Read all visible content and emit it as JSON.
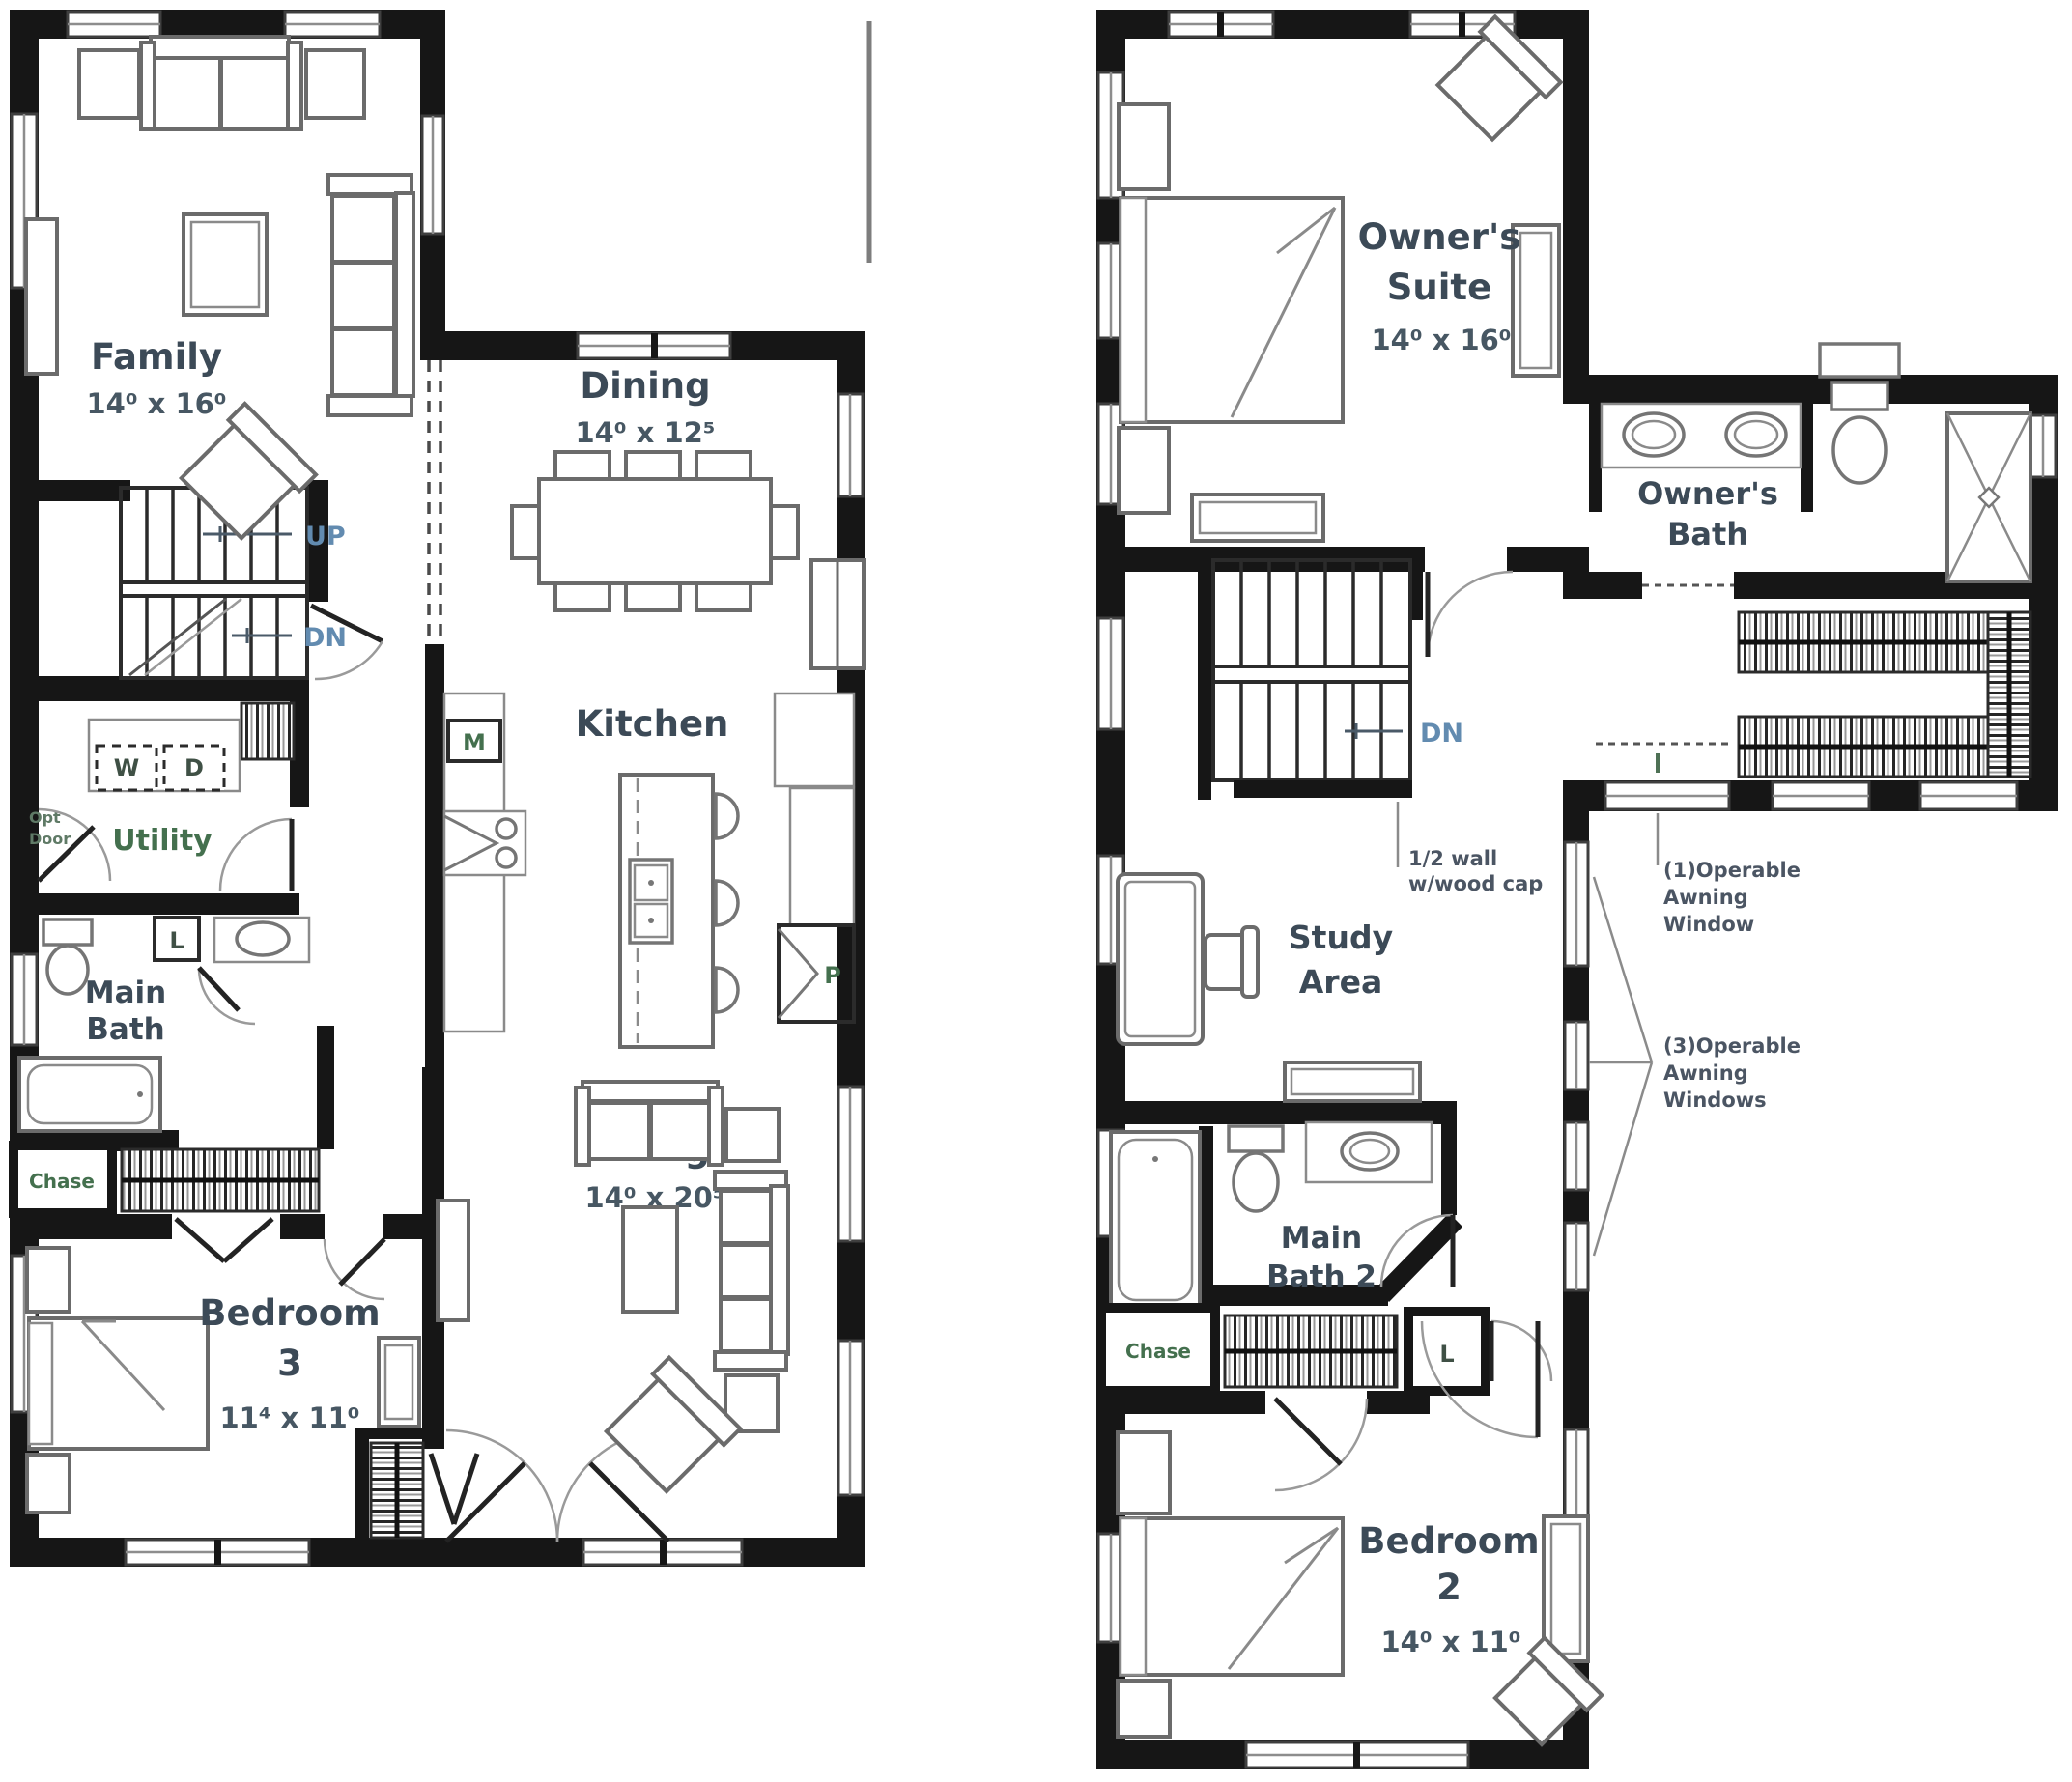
{
  "floor1": {
    "family": {
      "name": "Family",
      "dims": "14⁰ x 16⁰"
    },
    "dining": {
      "name": "Dining",
      "dims": "14⁰ x 12⁵"
    },
    "kitchen": {
      "name": "Kitchen"
    },
    "living": {
      "name": "Living",
      "dims": "14⁰ x 20⁵"
    },
    "utility": {
      "name": "Utility"
    },
    "main_bath": {
      "line1": "Main",
      "line2": "Bath"
    },
    "bedroom3": {
      "line1": "Bedroom",
      "line2": "3",
      "dims": "11⁴ x 11⁰"
    },
    "stair_up": "UP",
    "stair_dn": "DN",
    "washer": "W",
    "dryer": "D",
    "microwave": "M",
    "pantry": "P",
    "linen": "L",
    "chase": "Chase",
    "opt_door": {
      "line1": "Opt",
      "line2": "Door"
    }
  },
  "floor2": {
    "owners_suite": {
      "line1": "Owner's",
      "line2": "Suite",
      "dims": "14⁰ x 16⁰"
    },
    "owners_bath": {
      "line1": "Owner's",
      "line2": "Bath"
    },
    "study": {
      "line1": "Study",
      "line2": "Area"
    },
    "main_bath2": {
      "line1": "Main",
      "line2": "Bath 2"
    },
    "bedroom2": {
      "line1": "Bedroom",
      "line2": "2",
      "dims": "14⁰ x 11⁰"
    },
    "stair_dn": "DN",
    "chase": "Chase",
    "linen": "L",
    "half_wall": {
      "line1": "1/2 wall",
      "line2": "w/wood cap"
    },
    "awning1": {
      "line1": "(1)Operable",
      "line2": "Awning",
      "line3": "Window"
    },
    "awning3": {
      "line1": "(3)Operable",
      "line2": "Awning",
      "line3": "Windows"
    }
  }
}
